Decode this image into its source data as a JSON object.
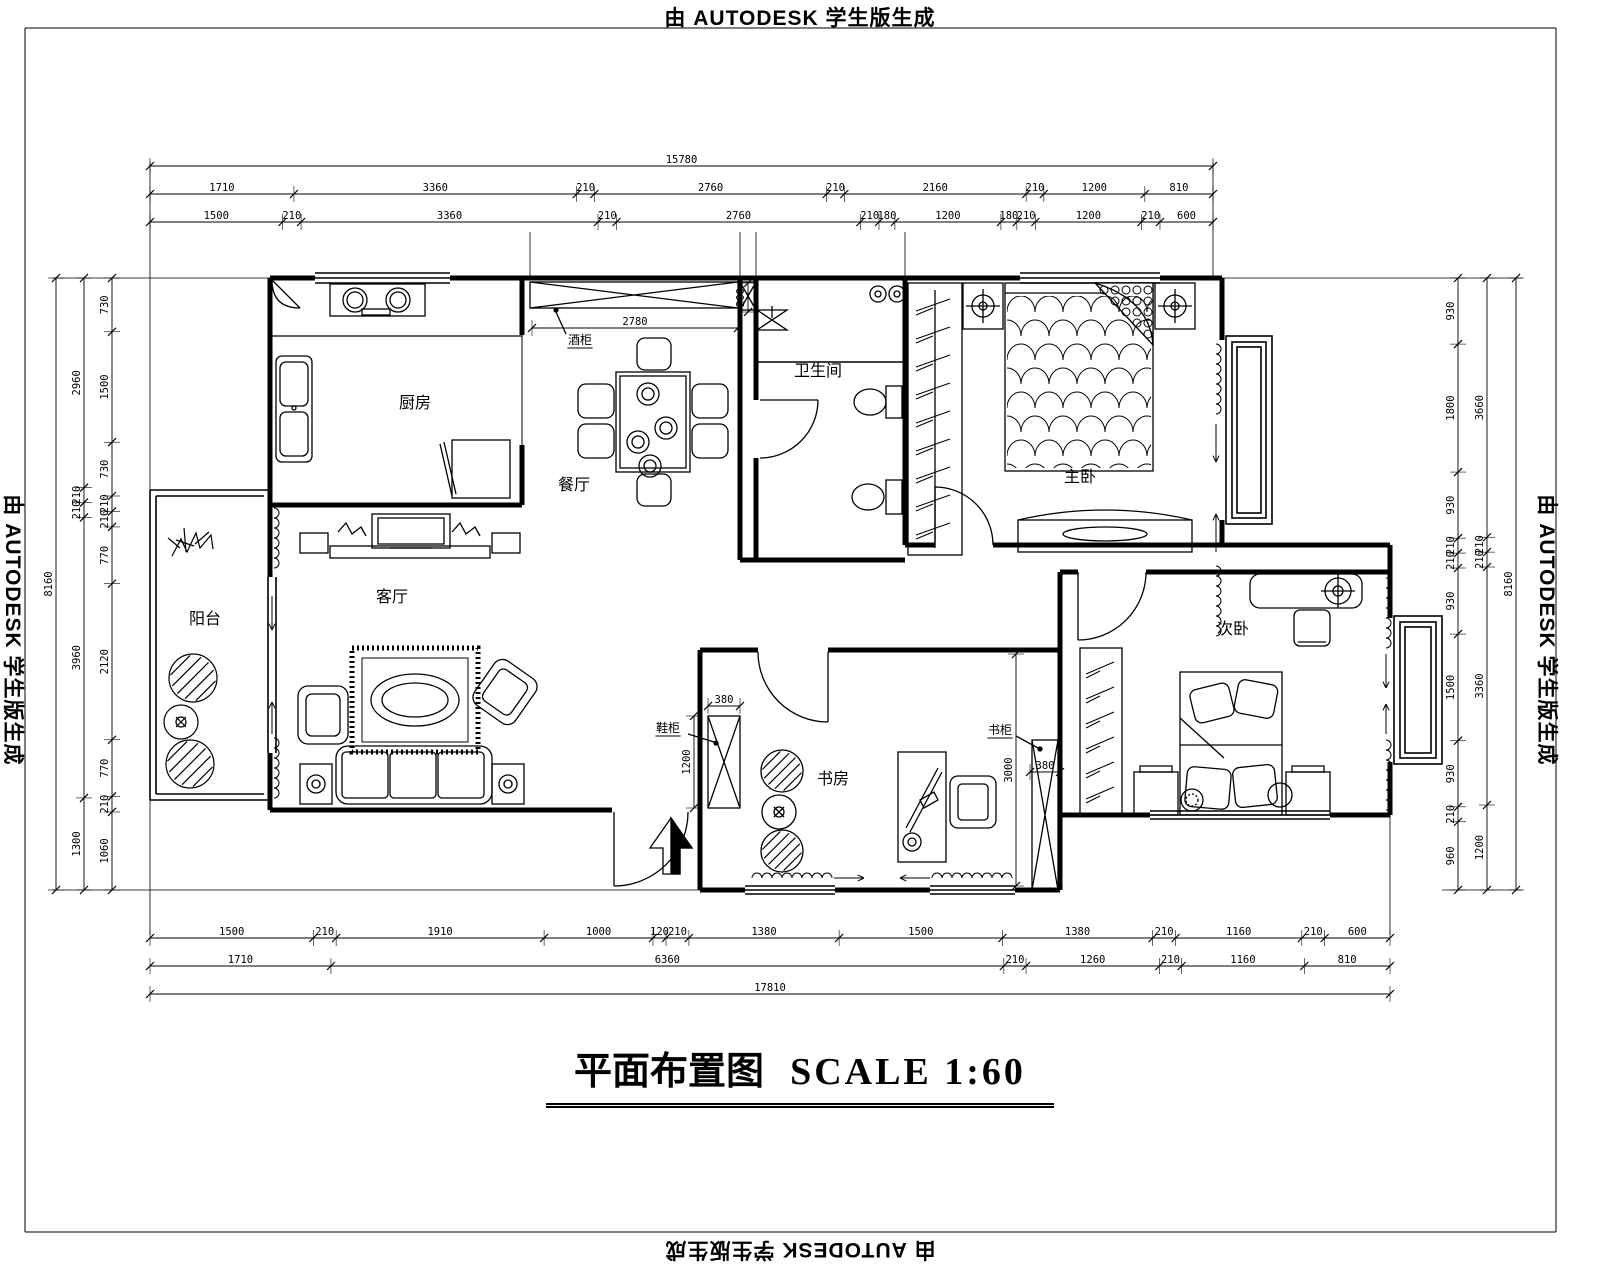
{
  "stamp": {
    "top": "由 AUTODESK 学生版生成",
    "left": "由 AUTODESK 学生版生成",
    "right": "由 AUTODESK 学生版生成",
    "bottom": "由 AUTODESK 学生版生成"
  },
  "title": {
    "name": "平面布置图",
    "scale": "SCALE 1:60"
  },
  "rooms": {
    "kitchen": "厨房",
    "dining": "餐厅",
    "bathroom": "卫生间",
    "master_bedroom": "主卧",
    "living_room": "客厅",
    "balcony": "阳台",
    "study": "书房",
    "second_bedroom": "次卧"
  },
  "annotations": {
    "wine_cabinet": "酒柜",
    "shoe_cabinet": "鞋柜",
    "bookcase": "书柜"
  },
  "dimensions": {
    "top": {
      "row1": [
        "15780"
      ],
      "row2": [
        "1710",
        "3360",
        "210",
        "2760",
        "210",
        "2160",
        "210",
        "1200",
        "810"
      ],
      "row3": [
        "1500",
        "210",
        "3360",
        "210",
        "2760",
        "210",
        "180",
        "1200",
        "180",
        "210",
        "1200",
        "210",
        "600"
      ]
    },
    "bottom": {
      "row1": [
        "1500",
        "210",
        "1910",
        "1000",
        "120",
        "210",
        "1380",
        "1500",
        "1380",
        "210",
        "1160",
        "210",
        "600"
      ],
      "row2": [
        "1710",
        "6360",
        "210",
        "1260",
        "210",
        "1160",
        "810"
      ],
      "row3": [
        "17810"
      ]
    },
    "left": {
      "outer": [
        "8160"
      ],
      "mid": [
        "2960",
        "210",
        "210",
        "3960",
        "1300"
      ],
      "inner": [
        "730",
        "1500",
        "730",
        "210",
        "210",
        "770",
        "2120",
        "770",
        "210",
        "1060"
      ]
    },
    "right": {
      "inner": [
        "930",
        "1800",
        "930",
        "210",
        "210",
        "930",
        "1500",
        "930",
        "210",
        "960"
      ],
      "mid": [
        "3660",
        "210",
        "210",
        "3360",
        "1200"
      ],
      "outer": [
        "8160"
      ]
    },
    "interior": {
      "dining_width": [
        "2780"
      ],
      "duct": [
        "200"
      ],
      "shoe_cab_width": [
        "380"
      ],
      "shoe_cab_depth": [
        "1200"
      ],
      "study_depth": [
        "3000"
      ],
      "bookcase_width": [
        "380"
      ]
    }
  },
  "colors": {
    "line": "#000000",
    "background": "#ffffff"
  }
}
